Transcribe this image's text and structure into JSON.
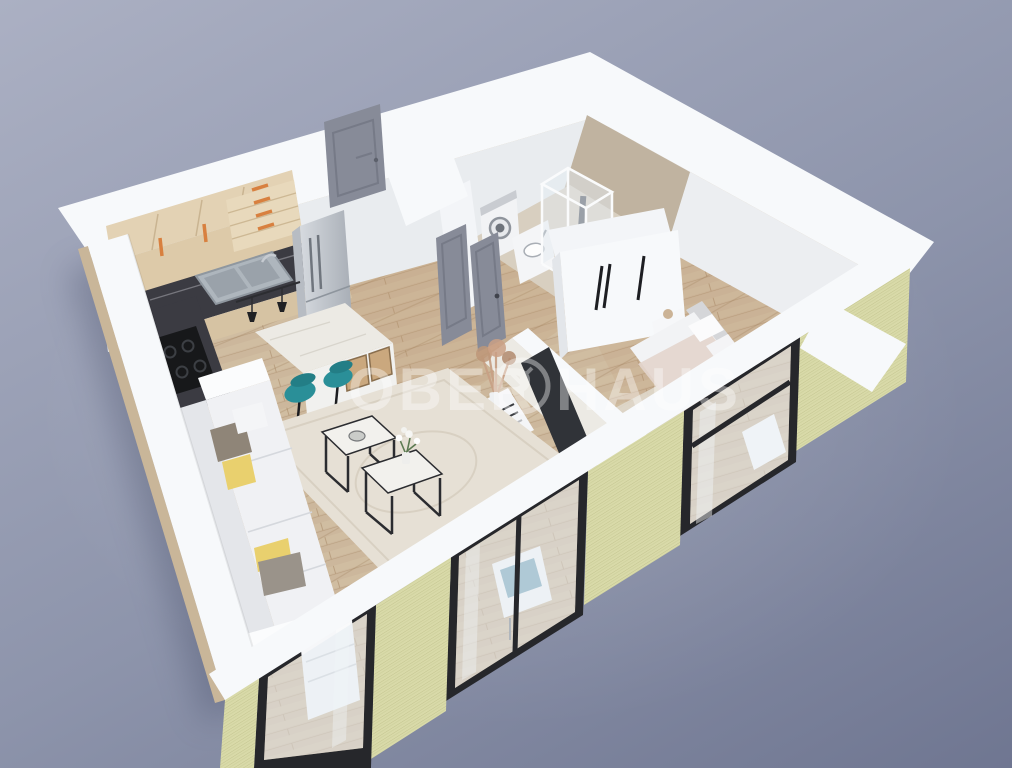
{
  "watermark": {
    "left": "OBER",
    "right": "HAUS",
    "logo": "ober-haus-ring-logo"
  },
  "scene": {
    "type": "isometric-3d-floor-plan-render",
    "rooms": [
      "kitchen",
      "hallway",
      "bathroom",
      "bedroom",
      "living-room"
    ],
    "furniture": [
      "kitchen-cabinets",
      "kitchen-sink",
      "stove",
      "fridge",
      "kitchen-island",
      "bar-stools",
      "pendant-lamps",
      "sofa",
      "coffee-tables",
      "armchair",
      "tv-divider-wall",
      "tv",
      "pampas-vase",
      "wardrobe",
      "bed",
      "nightstand",
      "washing-machine",
      "bathroom-vanity",
      "shower-cabin",
      "dresser",
      "rug"
    ],
    "colors": {
      "background_top": "#abb0c3",
      "background_mid": "#8d94ab",
      "background_bottom": "#6f7691",
      "wall_white": "#f3f5f8",
      "exterior_lime": "#d9daa9",
      "exterior_lime_stripe": "#c3c48f",
      "floor_wood": "#ccb79c",
      "floor_wood_stripe": "#b99f80",
      "tile_beige": "#d8cfc0",
      "bath_wall": "#c0b3a0",
      "rug_cream": "#e6e0d5",
      "counter_dark": "#3b3b42",
      "cabinet_wood": "#ddcaa9",
      "handle_orange": "#d8803f",
      "fridge_silver": "#c3c8cf",
      "door_gray": "#878b98",
      "frame_black": "#26272b",
      "sofa_white": "#f0f1f4",
      "pillow_gray": "#8f8578",
      "pillow_yellow": "#e9d06e",
      "stool_teal": "#2a8f98",
      "armchair_blue": "#7aa6ba",
      "tv_dark": "#303338",
      "marble_white": "#eceae4",
      "bed_blanket": "#e3d5cd",
      "glass_tint": "rgba(228,235,242,0.5)",
      "watermark_color": "#ffffff"
    }
  }
}
